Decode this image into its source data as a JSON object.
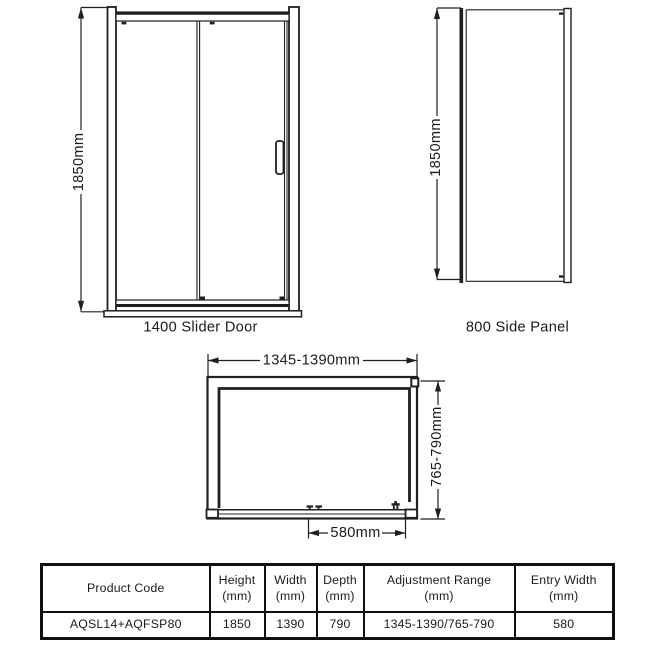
{
  "colors": {
    "line": "#1f1f1f",
    "text": "#1a1a1a",
    "table_border": "#101010",
    "background": "#ffffff"
  },
  "drawings": {
    "slider_door": {
      "caption": "1400 Slider Door",
      "height_dim": "1850mm"
    },
    "side_panel": {
      "caption": "800 Side Panel",
      "height_dim": "1850mm"
    },
    "plan_view": {
      "width_dim": "1345-1390mm",
      "depth_dim": "765-790mm",
      "entry_dim": "580mm"
    }
  },
  "spec_table": {
    "headers": [
      {
        "line1": "Product Code",
        "line2": ""
      },
      {
        "line1": "Height",
        "line2": "(mm)"
      },
      {
        "line1": "Width",
        "line2": "(mm)"
      },
      {
        "line1": "Depth",
        "line2": "(mm)"
      },
      {
        "line1": "Adjustment Range",
        "line2": "(mm)"
      },
      {
        "line1": "Entry Width",
        "line2": "(mm)"
      }
    ],
    "row": {
      "product_code": "AQSL14+AQFSP80",
      "height": "1850",
      "width": "1390",
      "depth": "790",
      "adjustment_range": "1345-1390/765-790",
      "entry_width": "580"
    }
  }
}
